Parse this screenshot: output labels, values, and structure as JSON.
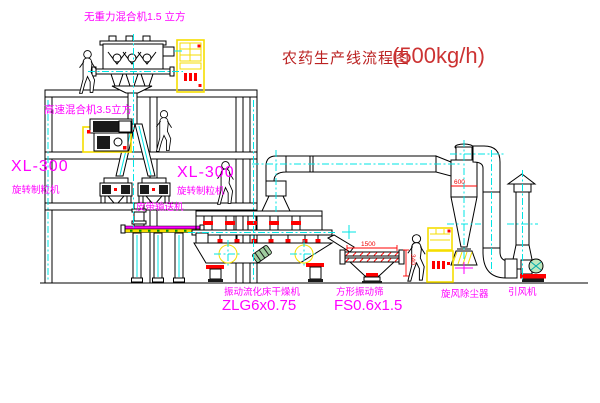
{
  "title": {
    "name": "农药生产线流程图",
    "capacity": "(500kg/h)"
  },
  "labels": {
    "top_mixer": "无重力混合机1.5 立方",
    "high_speed_mixer": "高速混合机3.5立方",
    "xl300_left": "XL-300",
    "granulator_left": "旋转制粒机",
    "xl300_mid": "XL-300",
    "granulator_mid": "旋转制粒机",
    "belt_conveyor": "皮带输送机",
    "dryer": "振动流化床干燥机",
    "dryer_model": "ZLG6x0.75",
    "sieve": "方形振动筛",
    "sieve_model": "FS0.6x1.5",
    "cyclone": "旋风除尘器",
    "fan": "引风机"
  },
  "dimensions": {
    "sieve_length": "1500",
    "sieve_height": "340",
    "cyclone_diameter": "600"
  },
  "colors": {
    "label_magenta": "#ff00ff",
    "title_red": "#bb2222",
    "capacity_red": "#cc3333",
    "accent_red": "#ff0000",
    "cabinet_yellow": "#f5de00",
    "centerline_cyan": "#00e5e5",
    "dot_green": "#008f00"
  }
}
